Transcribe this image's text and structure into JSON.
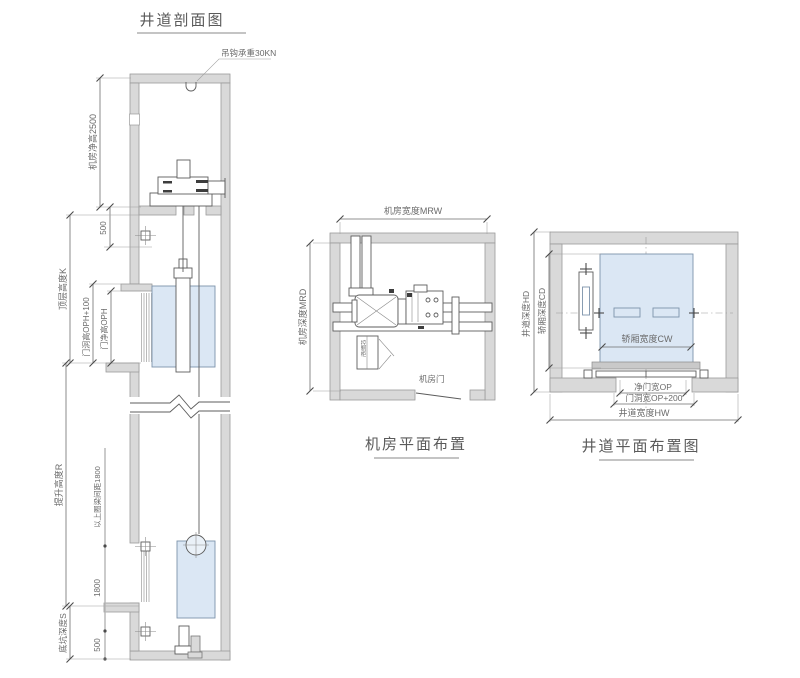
{
  "titles": {
    "section": "井道剖面图",
    "machine_room": "机房平面布置",
    "shaft_plan": "井道平面布置图"
  },
  "section_view": {
    "hook_label": "吊钩承重30KN",
    "dim_machine_room_height": "机房净高2500",
    "dim_500_top": "500",
    "dim_top_floor_height": "顶层高度K",
    "dim_door_opening_height": "门洞高OPH+100",
    "dim_door_clear_height": "门净高OPH",
    "dim_travel_height": "提升高度R",
    "dim_ring_beam_note": "以上圈梁间距1800",
    "dim_1800": "1800",
    "dim_pit_depth": "底坑深度S",
    "dim_500_bottom": "500"
  },
  "machine_room_view": {
    "dim_width": "机房宽度MRW",
    "dim_depth": "机房深度MRD",
    "control_cabinet_label": "控制柜",
    "door_label": "机房门"
  },
  "shaft_plan_view": {
    "dim_shaft_depth": "井道深度HD",
    "dim_car_depth": "轿厢深度CD",
    "dim_car_width": "轿厢宽度CW",
    "dim_door_clear_width": "净门宽OP",
    "dim_door_opening_width": "门洞宽OP+200",
    "dim_shaft_width": "井道宽度HW"
  },
  "colors": {
    "wall_fill": "#d9d9d9",
    "wall_stroke": "#9a9a9a",
    "line": "#5c5c5c",
    "car_fill": "#dbe7f4",
    "text": "#6b6b6b"
  }
}
